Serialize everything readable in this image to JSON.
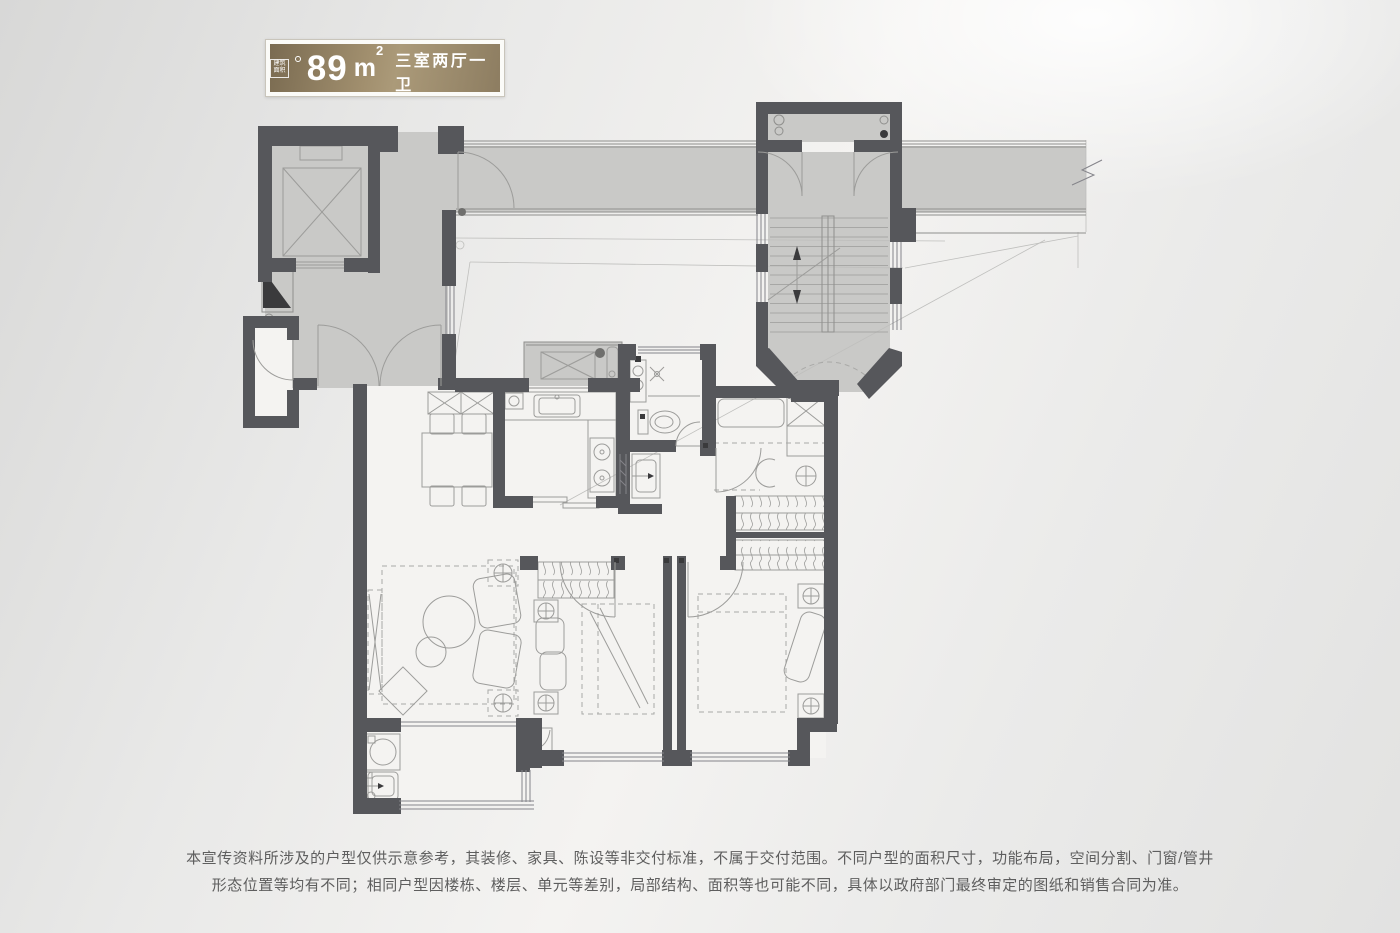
{
  "badge": {
    "icon_text_top": "建筑",
    "icon_text_bottom": "面积",
    "area_number": "89",
    "area_unit": "m",
    "area_exponent": "2",
    "layout_label": "三室两厅一卫"
  },
  "disclaimer": {
    "line1": "本宣传资料所涉及的户型仅供示意参考，其装修、家具、陈设等非交付标准，不属于交付范围。不同户型的面积尺寸，功能布局，空间分割、门窗/管井",
    "line2": "形态位置等均有不同；相同户型因楼栋、楼层、单元等差别，局部结构、面积等也可能不同，具体以政府部门最终审定的图纸和销售合同为准。"
  },
  "colors": {
    "wall": "#56575b",
    "zone_fill": "#c9c9c7",
    "room_fill": "#f4f3f1",
    "line": "#8f8f8d",
    "furniture": "#9c9c9a",
    "dashed": "#a9a9a7",
    "badge_dark": "#7a6b51",
    "badge_mid": "#a18f6e",
    "badge_light": "#ab9a79",
    "badge_frame": "#c9c5bb",
    "badge_text": "#ffffff",
    "disclaimer": "#5e5e5e"
  }
}
